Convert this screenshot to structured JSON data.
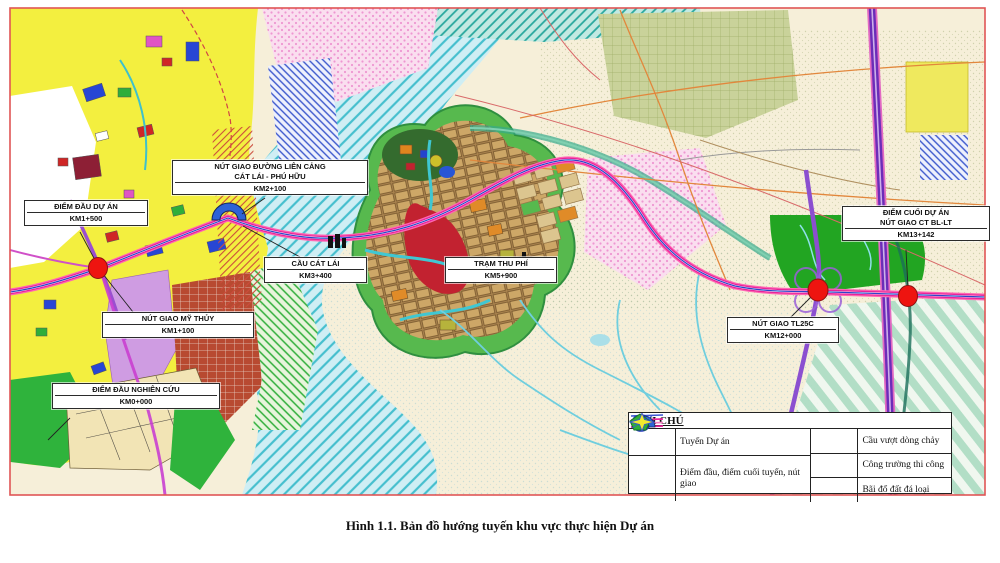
{
  "figure": {
    "caption": "Hình 1.1. Bản đồ hướng tuyến khu vực thực hiện Dự án"
  },
  "map": {
    "labels": {
      "lien_cang": {
        "line1": "NÚT GIAO ĐƯỜNG LIÊN CẢNG",
        "line2": "CÁT LÁI - PHÚ HỮU",
        "km": "KM2+100"
      },
      "diem_dau_du_an": {
        "line1": "ĐIỂM ĐẦU DỰ ÁN",
        "km": "KM1+500"
      },
      "my_thuy": {
        "line1": "NÚT GIAO MỸ THỦY",
        "km": "KM1+100"
      },
      "diem_dau_nghien_cuu": {
        "line1": "ĐIỂM ĐẦU NGHIÊN CỨU",
        "km": "KM0+000"
      },
      "cau_cat_lai": {
        "line1": "CẦU CÁT LÁI",
        "km": "KM3+400"
      },
      "tram_thu_phi": {
        "line1": "TRẠM THU PHÍ",
        "km": "KM5+900"
      },
      "diem_cuoi": {
        "line1": "ĐIỂM CUỐI DỰ ÁN",
        "line2": "NÚT GIAO CT BL-LT",
        "km": "KM13+142"
      },
      "tl25c": {
        "line1": "NÚT GIAO TL25C",
        "km": "KM12+000"
      }
    },
    "legend": {
      "title": "GHI CHÚ",
      "items": {
        "route": "Tuyến Dự án",
        "points": "Điểm đầu, điểm cuối tuyến, nút giao",
        "bridge": "Cầu vượt dòng chảy",
        "site": "Công trường thi công",
        "dump": "Bãi đổ đất đá loại"
      }
    },
    "colors": {
      "route_magenta": "#e8239a",
      "expressway_purple": "#6b2db8",
      "water_cyan": "#46bfce",
      "urban_yellow": "#f3ef3f",
      "node_red": "#ee1410",
      "frame_red": "#e05555"
    }
  }
}
